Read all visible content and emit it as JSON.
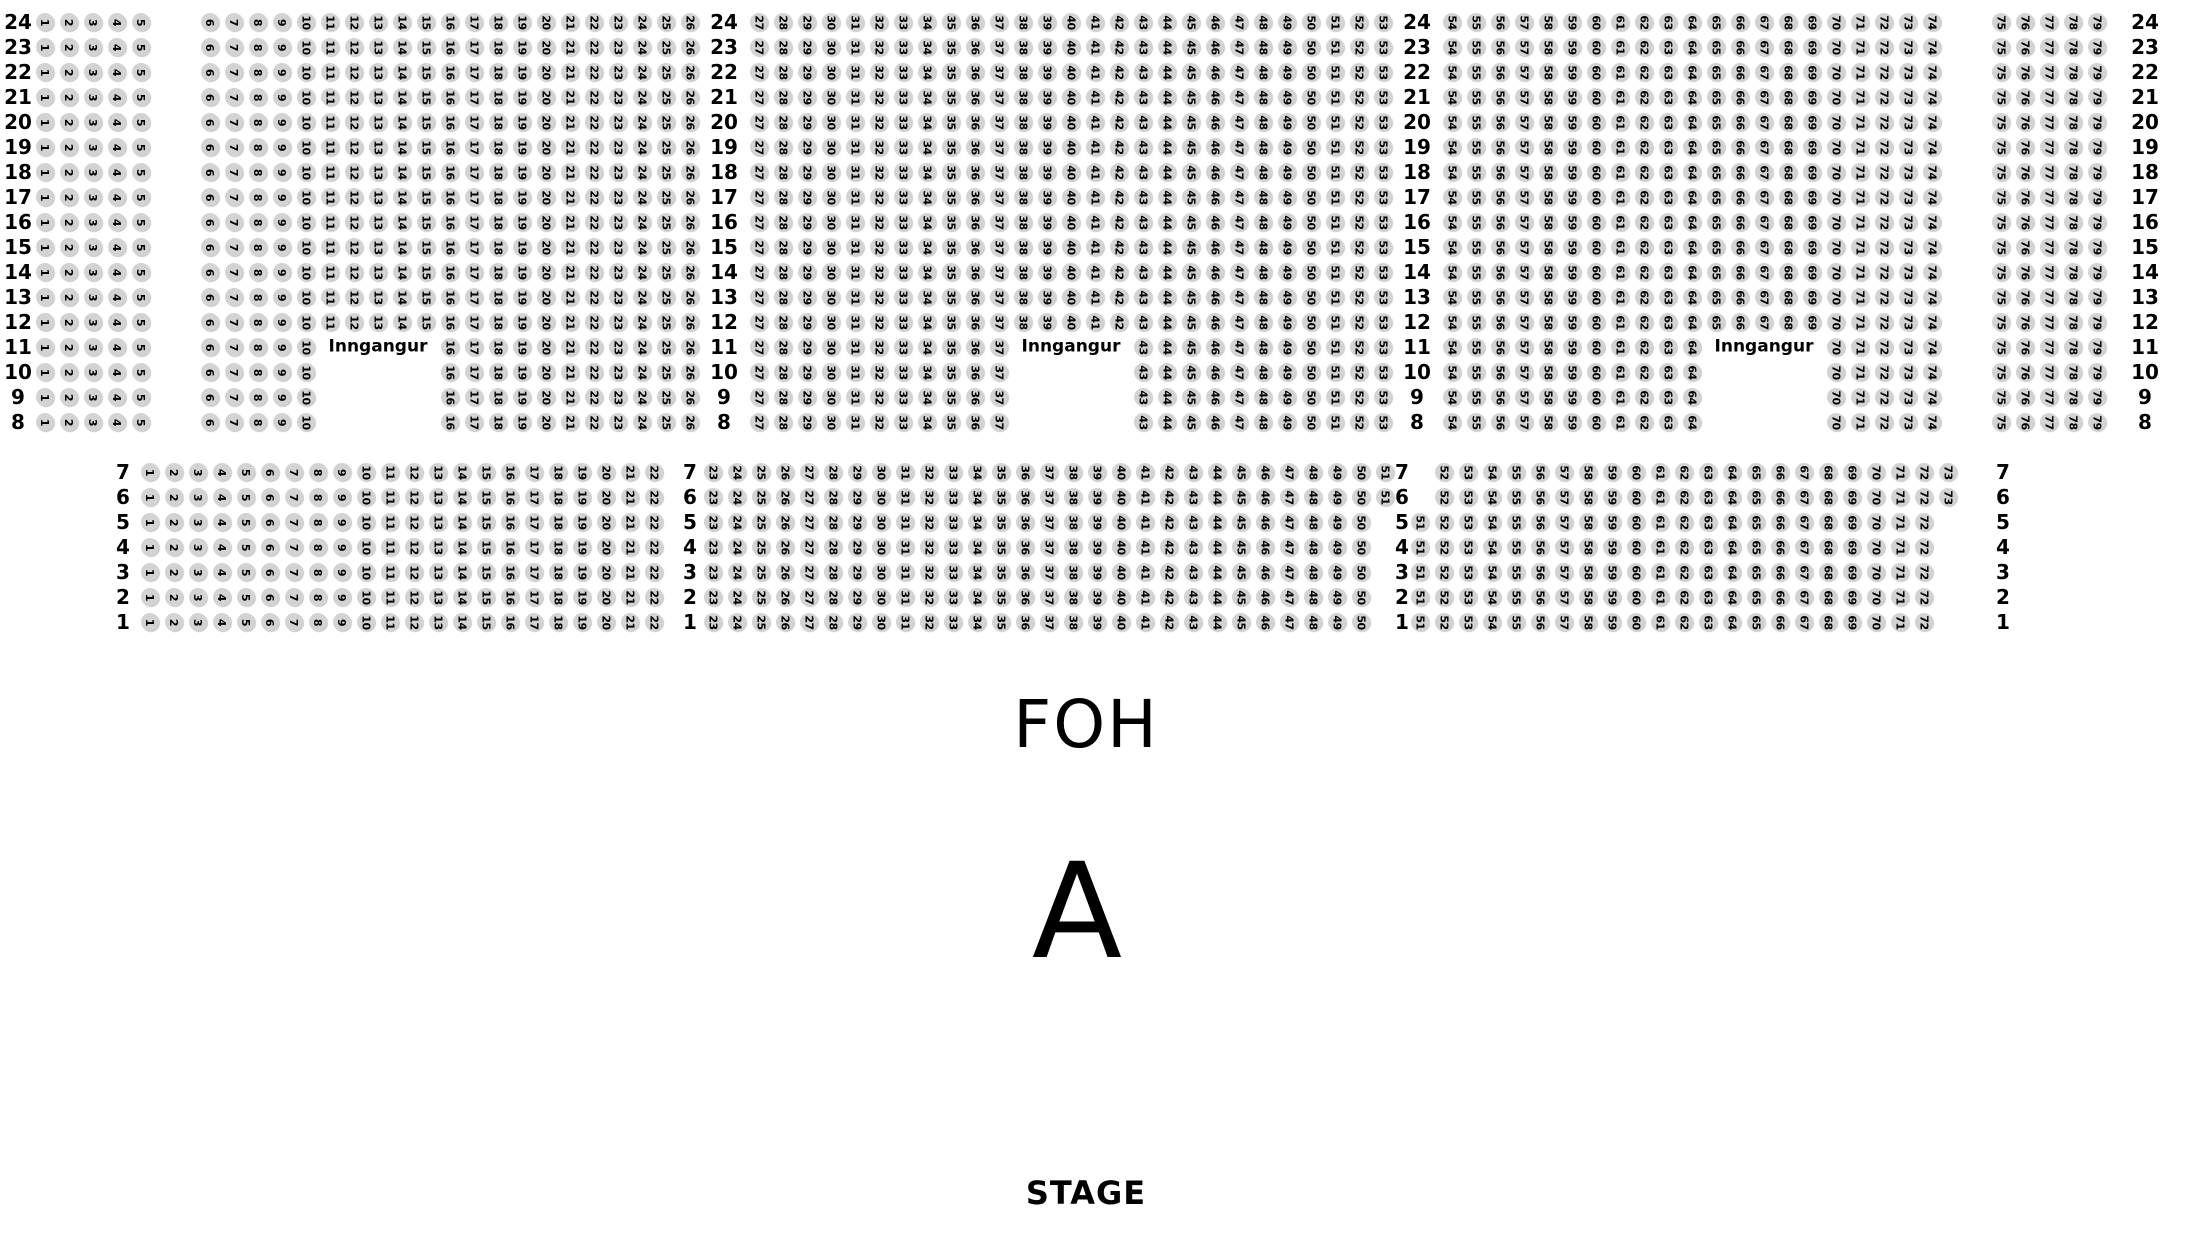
{
  "canvas": {
    "background": "#ffffff",
    "seat_fill": "#d3d3d3",
    "text_color": "#000000"
  },
  "labels": {
    "entrance": "Inngangur",
    "foh": "FOH",
    "section_letter": "A",
    "stage": "STAGE"
  },
  "top_section": {
    "aisles_after": [
      5,
      26,
      53,
      74
    ],
    "rows": [
      {
        "row": 24,
        "ranges": [
          [
            1,
            79
          ]
        ]
      },
      {
        "row": 23,
        "ranges": [
          [
            1,
            79
          ]
        ]
      },
      {
        "row": 22,
        "ranges": [
          [
            1,
            79
          ]
        ]
      },
      {
        "row": 21,
        "ranges": [
          [
            1,
            79
          ]
        ]
      },
      {
        "row": 20,
        "ranges": [
          [
            1,
            79
          ]
        ]
      },
      {
        "row": 19,
        "ranges": [
          [
            1,
            79
          ]
        ]
      },
      {
        "row": 18,
        "ranges": [
          [
            1,
            79
          ]
        ]
      },
      {
        "row": 17,
        "ranges": [
          [
            1,
            79
          ]
        ]
      },
      {
        "row": 16,
        "ranges": [
          [
            1,
            79
          ]
        ]
      },
      {
        "row": 15,
        "ranges": [
          [
            1,
            79
          ]
        ]
      },
      {
        "row": 14,
        "ranges": [
          [
            1,
            79
          ]
        ]
      },
      {
        "row": 13,
        "ranges": [
          [
            1,
            79
          ]
        ]
      },
      {
        "row": 12,
        "ranges": [
          [
            1,
            79
          ]
        ]
      },
      {
        "row": 11,
        "ranges": [
          [
            1,
            10
          ],
          [
            16,
            37
          ],
          [
            43,
            64
          ],
          [
            70,
            79
          ]
        ]
      },
      {
        "row": 10,
        "ranges": [
          [
            1,
            10
          ],
          [
            16,
            37
          ],
          [
            43,
            64
          ],
          [
            70,
            79
          ]
        ]
      },
      {
        "row": 9,
        "ranges": [
          [
            1,
            10
          ],
          [
            16,
            37
          ],
          [
            43,
            64
          ],
          [
            70,
            79
          ]
        ]
      },
      {
        "row": 8,
        "ranges": [
          [
            1,
            10
          ],
          [
            16,
            37
          ],
          [
            43,
            64
          ],
          [
            70,
            79
          ]
        ]
      }
    ],
    "entrances": [
      {
        "row": 11,
        "center_seat": 13
      },
      {
        "row": 11,
        "center_seat": 40
      },
      {
        "row": 11,
        "center_seat": 67
      }
    ]
  },
  "bottom_section": {
    "aisles_after": [
      22,
      50
    ],
    "rows": [
      {
        "row": 7,
        "ranges": [
          [
            1,
            73
          ]
        ],
        "aisles_after": [
          22,
          51
        ]
      },
      {
        "row": 6,
        "ranges": [
          [
            1,
            73
          ]
        ],
        "aisles_after": [
          22,
          51
        ]
      },
      {
        "row": 5,
        "ranges": [
          [
            1,
            72
          ]
        ]
      },
      {
        "row": 4,
        "ranges": [
          [
            1,
            72
          ]
        ]
      },
      {
        "row": 3,
        "ranges": [
          [
            1,
            72
          ]
        ]
      },
      {
        "row": 2,
        "ranges": [
          [
            1,
            72
          ]
        ]
      },
      {
        "row": 1,
        "ranges": [
          [
            1,
            72
          ]
        ]
      }
    ]
  }
}
